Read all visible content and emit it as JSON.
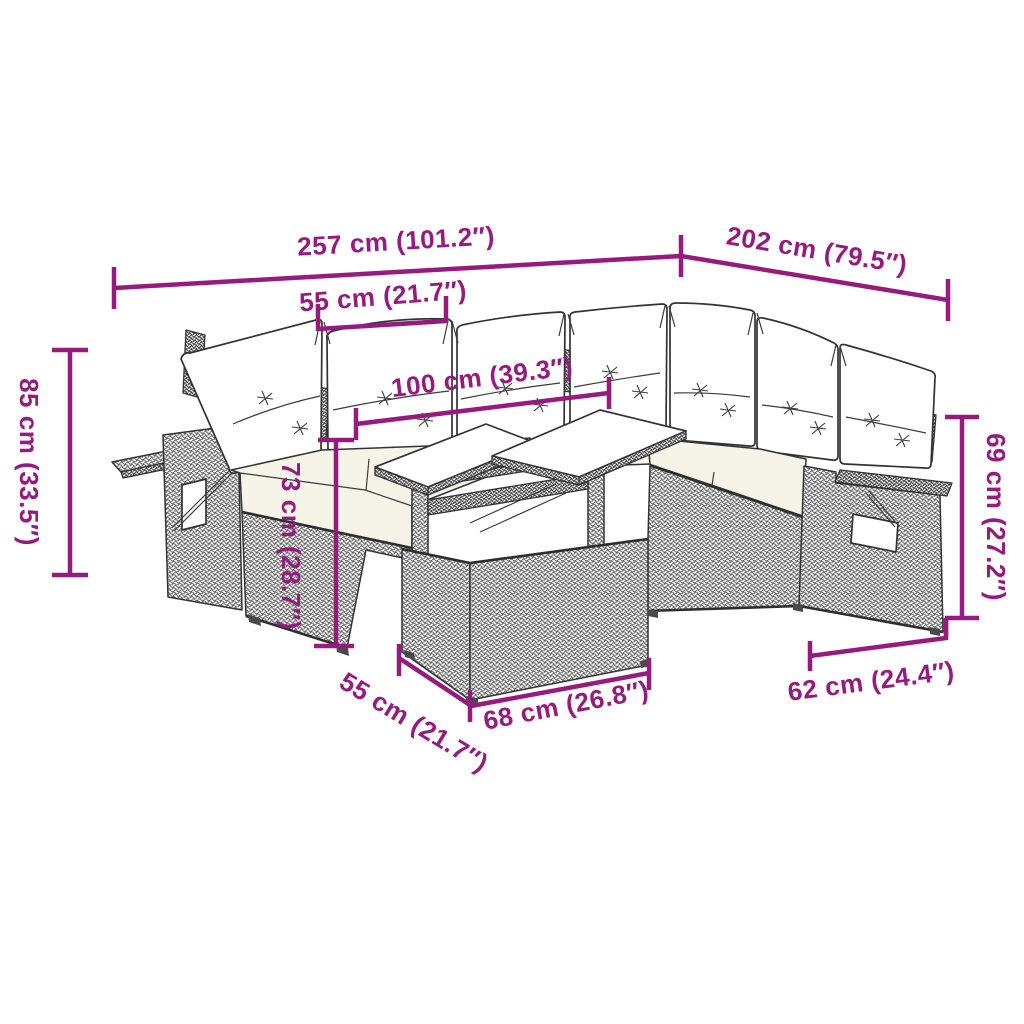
{
  "page": {
    "background": "#FFFFFF"
  },
  "diagram": {
    "subject": "poly-rattan-garden-lounge-set-dimension-diagram",
    "accent_color": "#951B7E",
    "outline_color": "#333333",
    "cushion_color": "#FFFFFF",
    "seat_cushion_color": "#F6F3E8"
  },
  "dims": {
    "overall_width": "257 cm (101.2″)",
    "overall_depth": "202 cm (79.5″)",
    "seat_width": "55 cm (21.7″)",
    "tabletop_span": "100 cm (39.3″)",
    "total_height": "85 cm (33.5″)",
    "table_height": "73 cm (28.7″)",
    "right_back_height": "69 cm (27.2″)",
    "seat_depth": "55 cm (21.7″)",
    "table_depth": "68 cm (26.8″)",
    "side_unit_depth": "62 cm (24.4″)"
  }
}
